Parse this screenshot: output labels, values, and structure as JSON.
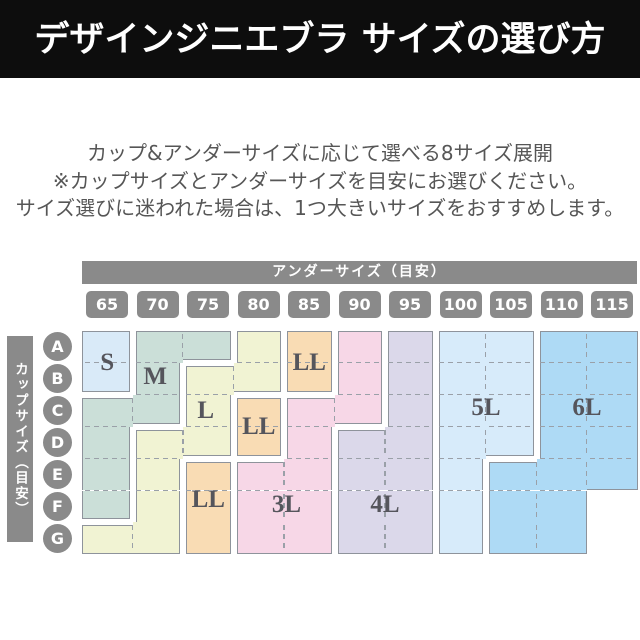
{
  "header": {
    "title": "デザインジニエブラ サイズの選び方",
    "bg_color": "#0d0d0d",
    "text_color": "#ffffff"
  },
  "intro": {
    "lines": [
      "カップ&アンダーサイズに応じて選べる8サイズ展開",
      "※カップサイズとアンダーサイズを目安にお選びください。",
      "サイズ選びに迷われた場合は、1つ大きいサイズをおすすめします。"
    ],
    "text_color": "#565656"
  },
  "chart_data": {
    "type": "heatmap",
    "under_label": "アンダーサイズ（目安）",
    "cup_label": "カップサイズ（目安）",
    "under_sizes": [
      "65",
      "70",
      "75",
      "80",
      "85",
      "90",
      "95",
      "100",
      "105",
      "110",
      "115"
    ],
    "cup_sizes": [
      "A",
      "B",
      "C",
      "D",
      "E",
      "F",
      "G"
    ],
    "ui_gray": "#8a8a8a",
    "outline_color": "#8e939b",
    "dash_color": "#9aa0a8",
    "label_color": "#55555c",
    "empty_cells": [
      [
        "115",
        "F"
      ],
      [
        "115",
        "G"
      ]
    ],
    "sizes": [
      {
        "name": "S",
        "color": "#d9eaf8",
        "labels": [
          [
            0.5,
            1.0
          ]
        ],
        "cells": [
          [
            "65",
            "A"
          ],
          [
            "65",
            "B"
          ]
        ]
      },
      {
        "name": "M",
        "color": "#cbdfd8",
        "labels": [
          [
            1.45,
            1.45
          ]
        ],
        "cells": [
          [
            "70",
            "A"
          ],
          [
            "75",
            "A"
          ],
          [
            "70",
            "B"
          ],
          [
            "65",
            "C"
          ],
          [
            "70",
            "C"
          ],
          [
            "65",
            "D"
          ],
          [
            "65",
            "E"
          ],
          [
            "65",
            "F"
          ]
        ]
      },
      {
        "name": "L",
        "color": "#f1f3d3",
        "labels": [
          [
            2.45,
            2.5
          ]
        ],
        "cells": [
          [
            "80",
            "A"
          ],
          [
            "80",
            "B"
          ],
          [
            "75",
            "B"
          ],
          [
            "75",
            "C"
          ],
          [
            "75",
            "D"
          ],
          [
            "70",
            "D"
          ],
          [
            "70",
            "E"
          ],
          [
            "70",
            "F"
          ],
          [
            "70",
            "G"
          ],
          [
            "65",
            "G"
          ]
        ]
      },
      {
        "name": "LL",
        "color": "#f9dcb4",
        "labels": [
          [
            4.5,
            1.0
          ],
          [
            3.5,
            3.0
          ],
          [
            2.5,
            5.3
          ]
        ],
        "cells": [
          [
            "85",
            "A"
          ],
          [
            "85",
            "B"
          ],
          [
            "80",
            "C"
          ],
          [
            "80",
            "D"
          ],
          [
            "75",
            "E"
          ],
          [
            "75",
            "F"
          ],
          [
            "75",
            "G"
          ]
        ]
      },
      {
        "name": "3L",
        "color": "#f7d7e7",
        "labels": [
          [
            4.05,
            5.45
          ]
        ],
        "cells": [
          [
            "90",
            "A"
          ],
          [
            "90",
            "B"
          ],
          [
            "90",
            "C"
          ],
          [
            "85",
            "C"
          ],
          [
            "85",
            "D"
          ],
          [
            "85",
            "E"
          ],
          [
            "85",
            "F"
          ],
          [
            "85",
            "G"
          ],
          [
            "80",
            "E"
          ],
          [
            "80",
            "F"
          ],
          [
            "80",
            "G"
          ]
        ]
      },
      {
        "name": "4L",
        "color": "#dbd8ea",
        "labels": [
          [
            6.0,
            5.45
          ]
        ],
        "cells": [
          [
            "95",
            "A"
          ],
          [
            "95",
            "B"
          ],
          [
            "95",
            "C"
          ],
          [
            "95",
            "D"
          ],
          [
            "95",
            "E"
          ],
          [
            "95",
            "F"
          ],
          [
            "95",
            "G"
          ],
          [
            "90",
            "D"
          ],
          [
            "90",
            "E"
          ],
          [
            "90",
            "F"
          ],
          [
            "90",
            "G"
          ]
        ]
      },
      {
        "name": "5L",
        "color": "#d7ebfa",
        "labels": [
          [
            8.0,
            2.4
          ]
        ],
        "cells": [
          [
            "100",
            "A"
          ],
          [
            "100",
            "B"
          ],
          [
            "100",
            "C"
          ],
          [
            "100",
            "D"
          ],
          [
            "100",
            "E"
          ],
          [
            "100",
            "F"
          ],
          [
            "100",
            "G"
          ],
          [
            "105",
            "A"
          ],
          [
            "105",
            "B"
          ],
          [
            "105",
            "C"
          ],
          [
            "105",
            "D"
          ]
        ]
      },
      {
        "name": "6L",
        "color": "#aedaf5",
        "labels": [
          [
            10.0,
            2.4
          ]
        ],
        "cells": [
          [
            "110",
            "A"
          ],
          [
            "110",
            "B"
          ],
          [
            "110",
            "C"
          ],
          [
            "110",
            "D"
          ],
          [
            "110",
            "E"
          ],
          [
            "110",
            "F"
          ],
          [
            "110",
            "G"
          ],
          [
            "115",
            "A"
          ],
          [
            "115",
            "B"
          ],
          [
            "115",
            "C"
          ],
          [
            "115",
            "D"
          ],
          [
            "115",
            "E"
          ],
          [
            "105",
            "E"
          ],
          [
            "105",
            "F"
          ],
          [
            "105",
            "G"
          ]
        ]
      }
    ]
  }
}
